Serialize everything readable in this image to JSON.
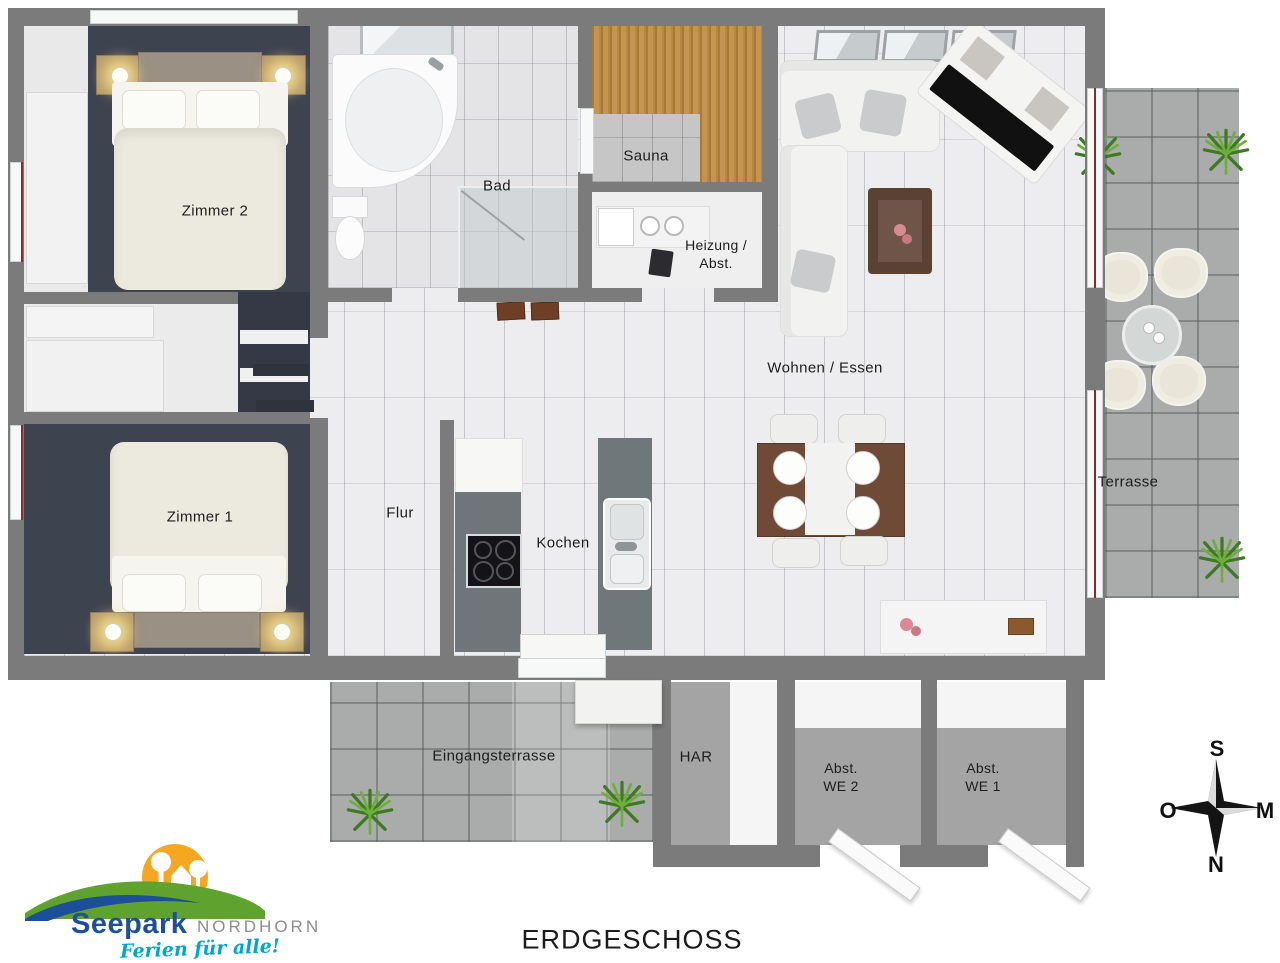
{
  "title": "ERDGESCHOSS",
  "logo": {
    "name": "Seepark",
    "place": "NORDHORN",
    "tagline": "Ferien für alle!"
  },
  "compass": {
    "top": "S",
    "right": "M",
    "bottom": "N",
    "left": "O"
  },
  "rooms": {
    "zimmer2": {
      "label": "Zimmer 2"
    },
    "zimmer1": {
      "label": "Zimmer 1"
    },
    "bad": {
      "label": "Bad"
    },
    "sauna": {
      "label": "Sauna"
    },
    "heizung": {
      "lines": [
        "Heizung /",
        "Abst."
      ]
    },
    "wohnen_essen": {
      "label": "Wohnen / Essen"
    },
    "flur": {
      "label": "Flur"
    },
    "kochen": {
      "label": "Kochen"
    },
    "terrasse": {
      "label": "Terrasse"
    },
    "eingangsterrasse": {
      "label": "Eingangsterrasse"
    },
    "har": {
      "label": "HAR"
    },
    "abst_we2": {
      "lines": [
        "Abst.",
        "WE 2"
      ]
    },
    "abst_we1": {
      "lines": [
        "Abst.",
        "WE 1"
      ]
    }
  },
  "colors": {
    "wall": "#7b7b7c",
    "carpet": "#3e4350",
    "interior_tile": "#ededef",
    "terrace_tile": "#a9acab",
    "sauna_wood": "#b9873f",
    "logo_blue": "#1d4f9b",
    "logo_green": "#5fa32e",
    "logo_sun": "#f6a722",
    "logo_cyan": "#00a5c8",
    "logo_gray": "#8c8c8c"
  }
}
